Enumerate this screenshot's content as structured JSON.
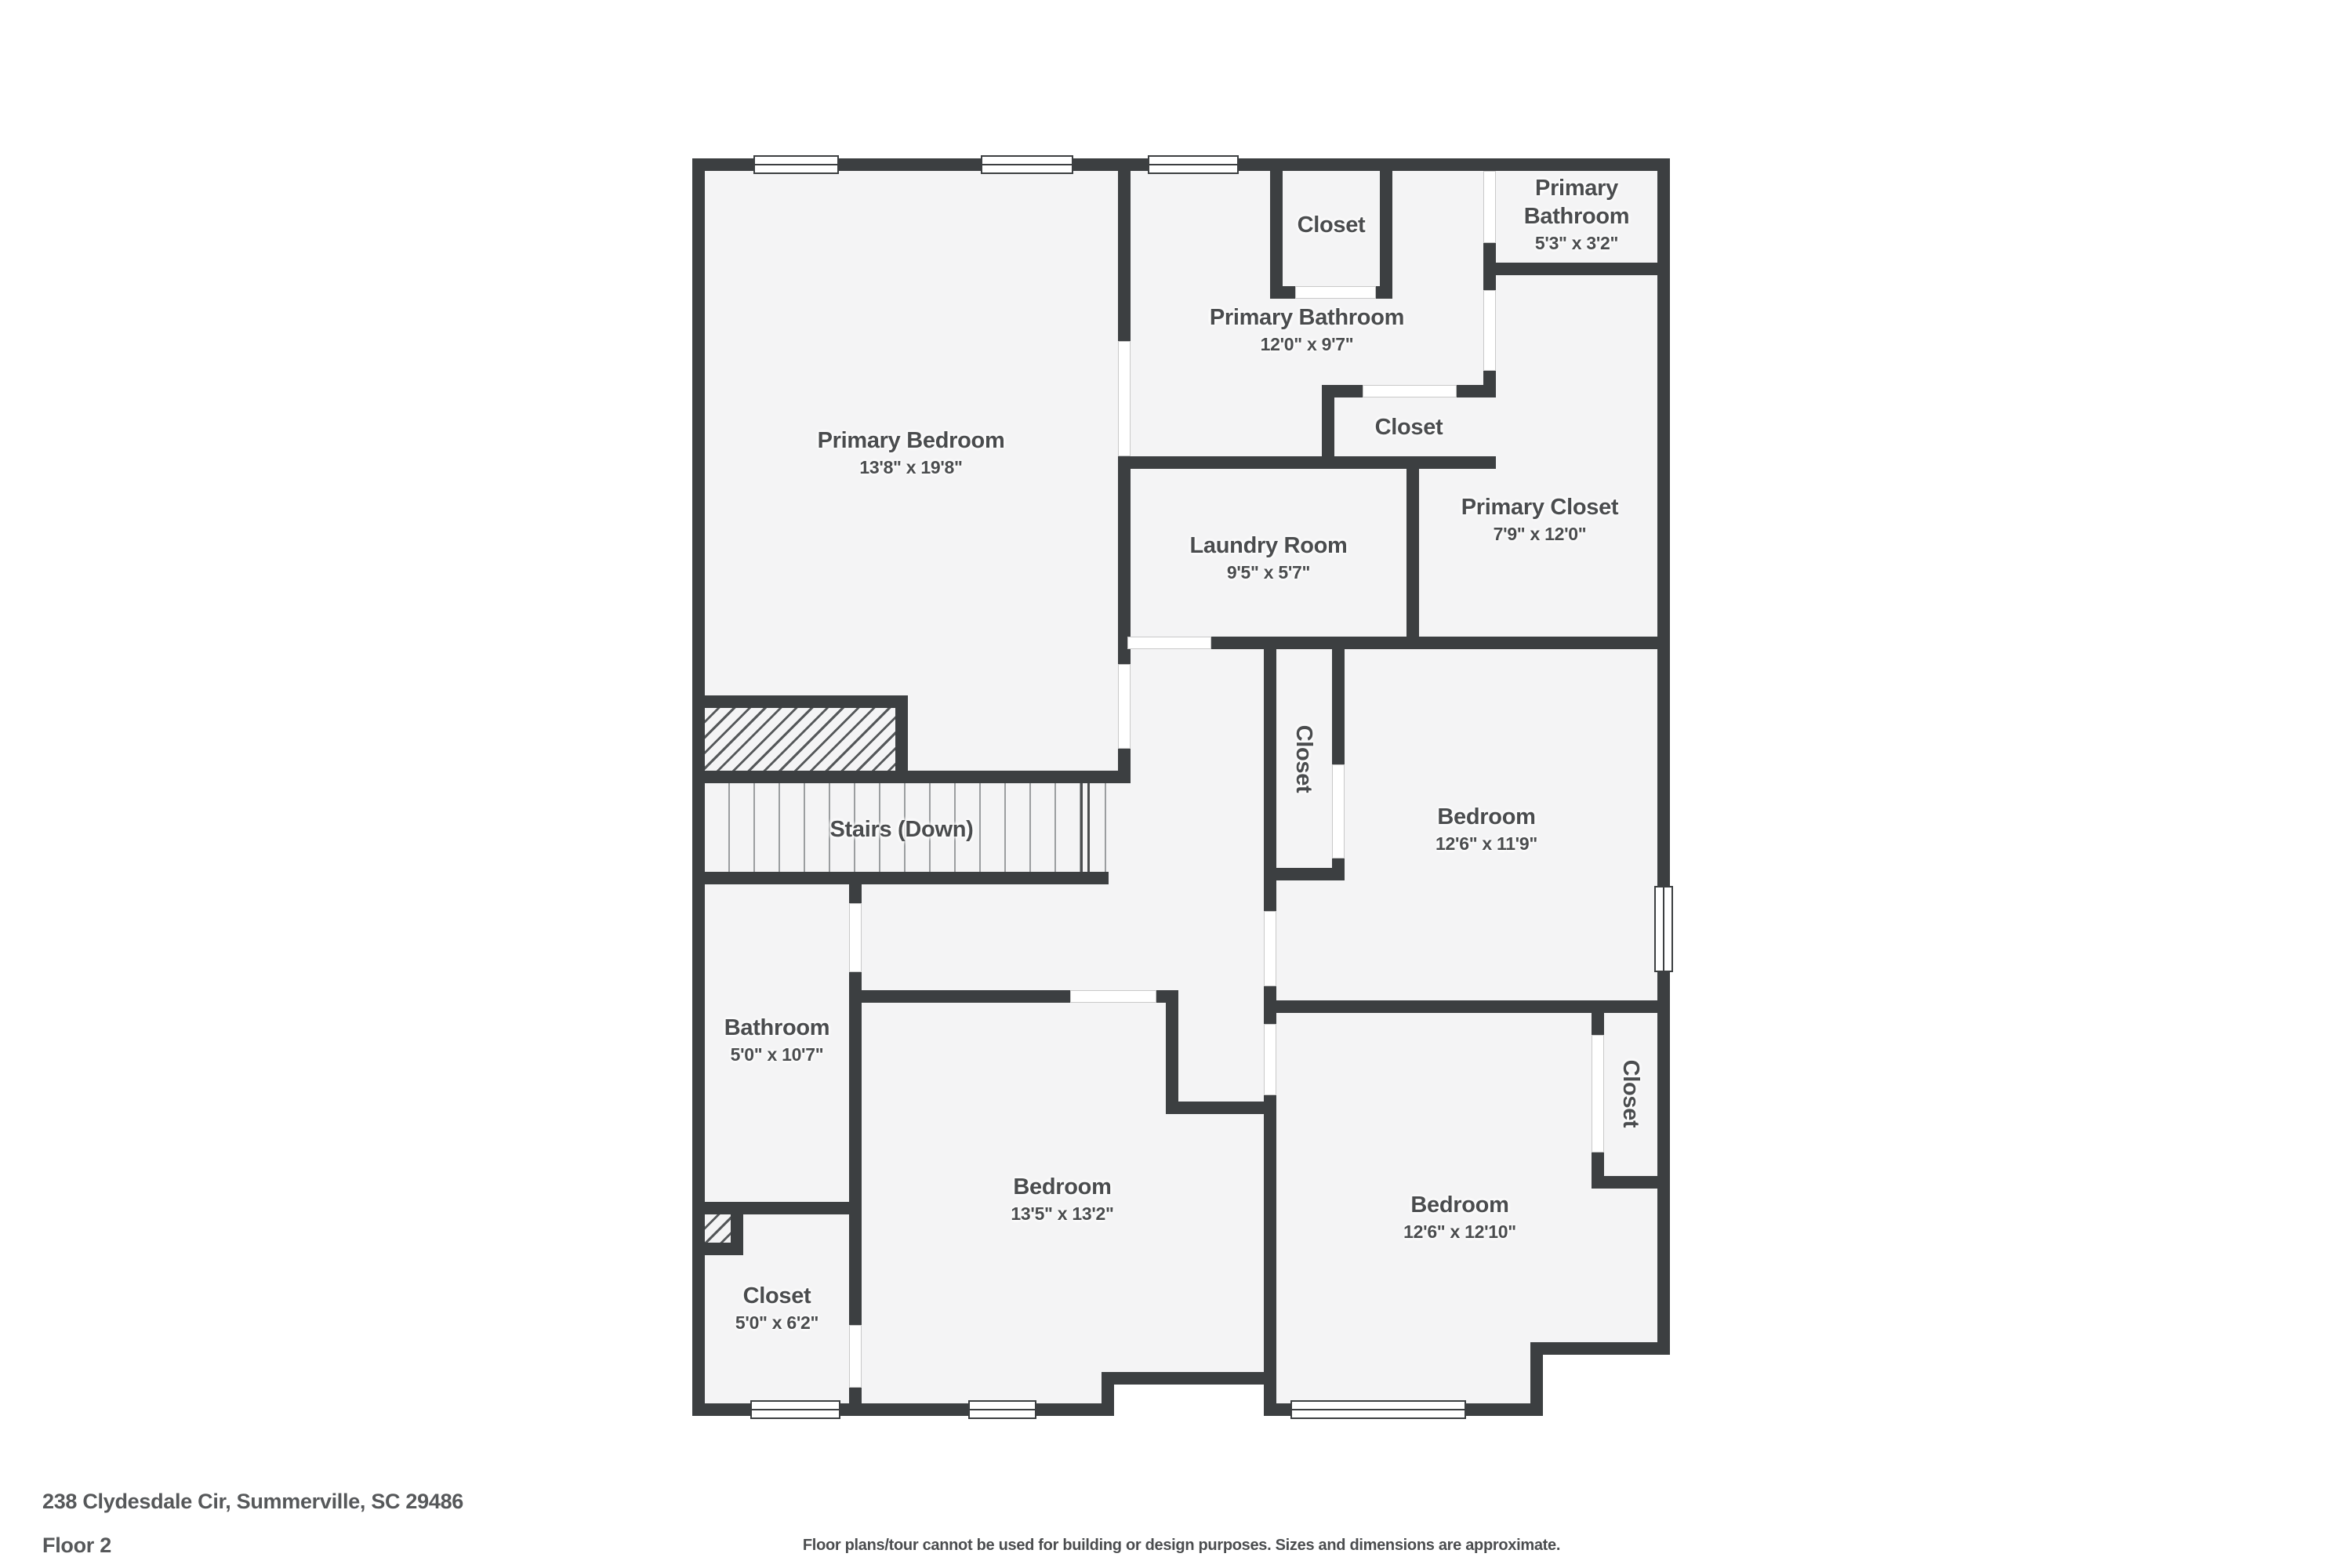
{
  "rooms": {
    "primary_bedroom": {
      "name": "Primary Bedroom",
      "dims": "13'8\" x 19'8\""
    },
    "closet_top": {
      "name": "Closet"
    },
    "primary_bathroom": {
      "name": "Primary Bathroom",
      "dims": "12'0\" x 9'7\""
    },
    "primary_bathroom_small": {
      "name": "Primary Bathroom",
      "dims": "5'3\" x 3'2\""
    },
    "closet_mid": {
      "name": "Closet"
    },
    "laundry": {
      "name": "Laundry Room",
      "dims": "9'5\" x 5'7\""
    },
    "primary_closet": {
      "name": "Primary Closet",
      "dims": "7'9\" x 12'0\""
    },
    "stairs": {
      "name": "Stairs (Down)"
    },
    "closet_hall": {
      "name": "Closet"
    },
    "bedroom_ne": {
      "name": "Bedroom",
      "dims": "12'6\" x 11'9\""
    },
    "bathroom": {
      "name": "Bathroom",
      "dims": "5'0\" x 10'7\""
    },
    "bedroom_sw": {
      "name": "Bedroom",
      "dims": "13'5\" x 13'2\""
    },
    "bedroom_se": {
      "name": "Bedroom",
      "dims": "12'6\" x 12'10\""
    },
    "closet_se": {
      "name": "Closet"
    },
    "closet_sw": {
      "name": "Closet",
      "dims": "5'0\" x 6'2\""
    }
  },
  "footer": {
    "address": "238 Clydesdale Cir, Summerville, SC 29486",
    "floor": "Floor 2",
    "disclaimer": "Floor plans/tour cannot be used for building or design purposes. Sizes and dimensions are approximate."
  }
}
